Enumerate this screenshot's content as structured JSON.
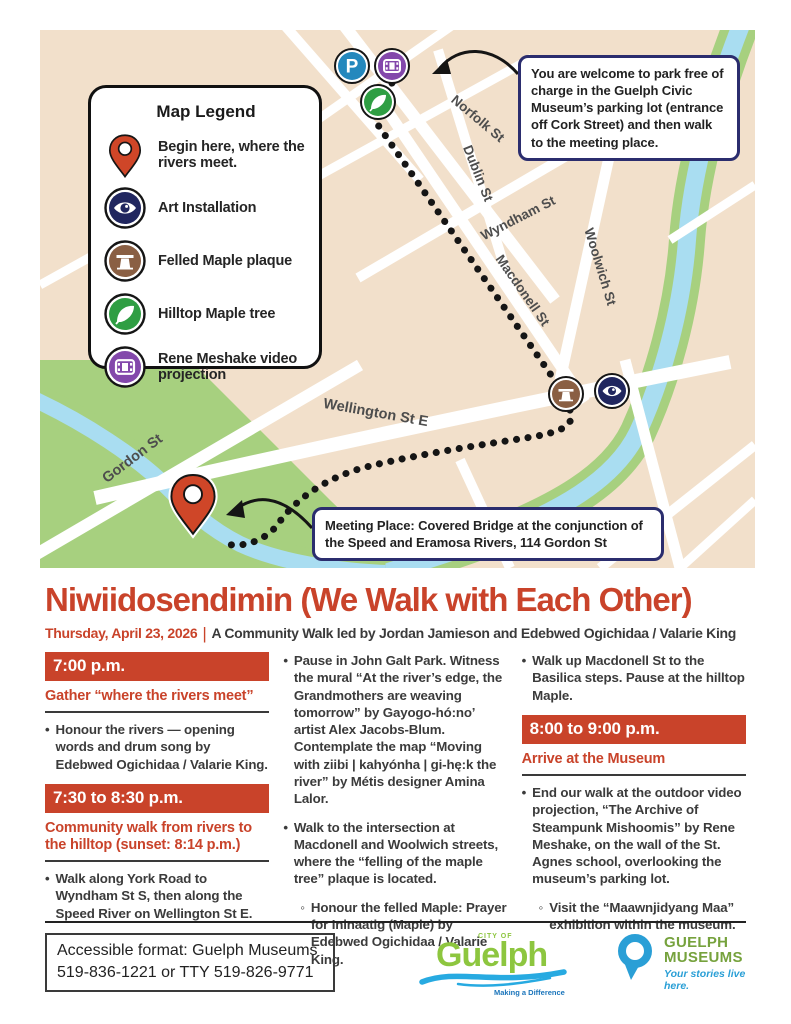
{
  "colors": {
    "accent_red": "#c9432a",
    "callout_navy": "#2b2d6e",
    "map_tan": "#f2e0cb",
    "map_green": "#a7d07f",
    "map_water": "#a9ddf1",
    "marker_blue": "#2488bd",
    "marker_purple": "#8348ab",
    "marker_green": "#2f9e43",
    "marker_brown": "#8a5f43",
    "marker_navy": "#20265f",
    "pin_red": "#cf4628",
    "logo_green": "#8dc63f",
    "logo_blue": "#27aae1",
    "museums_green": "#76a23d",
    "museums_blue": "#2a9fd6"
  },
  "map": {
    "parking_label": "P",
    "legend": {
      "title": "Map Legend",
      "items": [
        {
          "icon": "pin-icon",
          "label": "Begin here, where the rivers meet."
        },
        {
          "icon": "eye-icon",
          "label": "Art Installation"
        },
        {
          "icon": "stump-icon",
          "label": "Felled Maple plaque"
        },
        {
          "icon": "leaf-icon",
          "label": "Hilltop Maple tree"
        },
        {
          "icon": "film-icon",
          "label": "Rene Meshake video projection"
        }
      ]
    },
    "callouts": {
      "parking": "You are welcome to park free of charge in the Guelph Civic Museum’s parking lot (entrance off Cork Street) and then walk to the meeting place.",
      "meeting": "Meeting Place: Covered Bridge at the conjunction of the Speed and Eramosa Rivers, 114 Gordon St"
    },
    "streets": [
      "Norfolk St",
      "Dublin St",
      "Wyndham St",
      "Macdonell St",
      "Woolwich St",
      "Wellington St E",
      "Gordon St"
    ]
  },
  "title": "Niwiidosendimin (We Walk with Each Other)",
  "subtitle": {
    "date": "Thursday, April 23, 2026",
    "separator": "|",
    "text": "A Community Walk led by Jordan Jamieson and Edebwed Ogichidaa / Valarie King"
  },
  "bullets": {
    "dot": "•",
    "circle": "◦"
  },
  "schedule": {
    "col1": {
      "banner1": "7:00 p.m.",
      "head1": "Gather “where the rivers meet”",
      "bullet1": "Honour the rivers — opening words and drum song by Edebwed Ogichidaa / Valarie King.",
      "banner2": "7:30 to 8:30 p.m.",
      "head2": "Community walk from rivers to the hilltop (sunset: 8:14 p.m.)",
      "bullet2": "Walk along York Road to Wyndham St S, then along the Speed River on Wellington St E."
    },
    "col2": {
      "bullet1": "Pause in John Galt Park. Witness the mural “At the river’s edge, the Grandmothers are weaving tomorrow” by Gayogo-hó:no’ artist Alex Jacobs-Blum. Contemplate the map “Moving with ziibi | kahyónha | gi-hę:k the river” by Métis designer Amina Lalor.",
      "bullet2": "Walk to the intersection at Macdonell and Woolwich streets, where the “felling of the maple tree” plaque is located.",
      "subbullet": "Honour the felled Maple: Prayer for Ininaatig (Maple) by Edebwed Ogichidaa / Valarie King."
    },
    "col3": {
      "bullet1": "Walk up Macdonell St to the Basilica steps. Pause at the hilltop Maple.",
      "banner1": "8:00 to 9:00 p.m.",
      "head1": "Arrive at the Museum",
      "bullet2": "End our walk at the outdoor video projection, “The Archive of Steampunk Mishoomis” by Rene Meshake, on the wall of the St. Agnes school, overlooking the museum’s parking lot.",
      "subbullet": "Visit the “Maawnjidyang Maa” exhibition within the museum."
    }
  },
  "footer": {
    "accessible_line1": "Accessible format: Guelph Museums",
    "accessible_line2": "519-836-1221 or TTY 519-826-9771",
    "city_logo": {
      "city_of": "CITY OF",
      "name": "Guelph",
      "tagline": "Making a Difference"
    },
    "museums_logo": {
      "name_line1": "GUELPH",
      "name_line2": "MUSEUMS",
      "tagline": "Your stories live here."
    }
  }
}
